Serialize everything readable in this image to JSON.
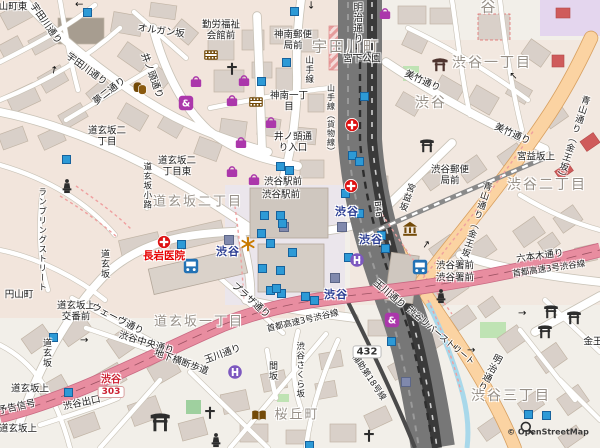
{
  "map_title": "Shibuya area map",
  "attribution": "© OpenStreetMap",
  "colors": {
    "background": "#f2efe9",
    "motorway": "#e88da0",
    "primary_road": "#fbd3a2",
    "retail_tint": "#f3dcd2",
    "rail": "#6f6f6f",
    "water": "#a8d8ea",
    "park_green": "#bfe3b4",
    "station_text": "#2b3d93",
    "shop_purple": "#ab37ab",
    "poi_brown": "#734a08",
    "hospital_red": "#dd1111",
    "entrance_blue": "#2d9ad6"
  },
  "labels": [
    {
      "t": "山町東",
      "x": 13,
      "y": 8,
      "c": "s"
    },
    {
      "t": "宇田川通り",
      "x": 45,
      "y": 24,
      "c": "s",
      "r": 55
    },
    {
      "t": "宇田川通り",
      "x": 86,
      "y": 70,
      "c": "s",
      "r": 36
    },
    {
      "t": "オルガン坂",
      "x": 161,
      "y": 32,
      "c": "s",
      "r": 8
    },
    {
      "t": "宇田川町",
      "x": 346,
      "y": 47,
      "c": "a",
      "fs": 15
    },
    {
      "t": "井ノ頭通り",
      "x": 151,
      "y": 76,
      "c": "s",
      "r": 70
    },
    {
      "t": "夢二通り",
      "x": 110,
      "y": 92,
      "c": "s",
      "r": -38
    },
    {
      "t": "勤労福祉\n会館前",
      "x": 221,
      "y": 31,
      "c": "s"
    },
    {
      "t": "神南郵便\n局前",
      "x": 293,
      "y": 41,
      "c": "s"
    },
    {
      "t": "宮下公園",
      "x": 362,
      "y": 60,
      "c": "s"
    },
    {
      "t": "神南一丁\n目",
      "x": 289,
      "y": 102,
      "c": "s"
    },
    {
      "t": "山手線",
      "x": 308,
      "y": 70,
      "c": "s",
      "v": 1,
      "fs": 8.5
    },
    {
      "t": "山手線（貨物線）",
      "x": 330,
      "y": 120,
      "c": "s",
      "v": 1,
      "fs": 8
    },
    {
      "t": "明治通り",
      "x": 356,
      "y": 23,
      "c": "s",
      "v": 1
    },
    {
      "t": "谷",
      "x": 489,
      "y": 7,
      "c": "a",
      "fs": 15
    },
    {
      "t": "渋谷一丁目",
      "x": 492,
      "y": 64,
      "c": "a",
      "fs": 14
    },
    {
      "t": "渋谷",
      "x": 431,
      "y": 104,
      "c": "a",
      "fs": 14
    },
    {
      "t": "美竹通り",
      "x": 422,
      "y": 82,
      "c": "s",
      "r": 24
    },
    {
      "t": "美竹通り",
      "x": 512,
      "y": 135,
      "c": "s",
      "r": 24
    },
    {
      "t": "宮益坂上",
      "x": 536,
      "y": 158,
      "c": "s"
    },
    {
      "t": "渋谷二丁目",
      "x": 547,
      "y": 186,
      "c": "a",
      "fs": 14
    },
    {
      "t": "青山通り（金王坂）",
      "x": 474,
      "y": 224,
      "c": "s",
      "v": 1,
      "r": 18,
      "fs": 9
    },
    {
      "t": "青山通り（金王坂）",
      "x": 572,
      "y": 138,
      "c": "s",
      "v": 1,
      "r": 18,
      "fs": 9
    },
    {
      "t": "宮益坂",
      "x": 406,
      "y": 197,
      "c": "s",
      "v": 1,
      "r": 20,
      "fs": 9
    },
    {
      "t": "渋谷郵便\n局前",
      "x": 450,
      "y": 176,
      "c": "s"
    },
    {
      "t": "道玄坂二\n丁目",
      "x": 107,
      "y": 137,
      "c": "s"
    },
    {
      "t": "道玄坂二\n丁目東",
      "x": 177,
      "y": 167,
      "c": "s"
    },
    {
      "t": "道玄坂二丁目",
      "x": 198,
      "y": 203,
      "c": "a",
      "fs": 13
    },
    {
      "t": "道玄坂小路",
      "x": 146,
      "y": 186,
      "c": "s",
      "v": 1,
      "fs": 8.5
    },
    {
      "t": "ランブリングストリート",
      "x": 41,
      "y": 240,
      "c": "s",
      "v": 1,
      "fs": 8.5
    },
    {
      "t": "道玄坂",
      "x": 104,
      "y": 264,
      "c": "s",
      "v": 1,
      "fs": 9
    },
    {
      "t": "長岩医院",
      "x": 164,
      "y": 257,
      "c": "pr"
    },
    {
      "t": "渋谷駅前",
      "x": 283,
      "y": 183,
      "c": "s"
    },
    {
      "t": "渋谷駅前",
      "x": 281,
      "y": 196,
      "c": "s"
    },
    {
      "t": "井ノ頭通\nり入口",
      "x": 293,
      "y": 143,
      "c": "s"
    },
    {
      "t": "渋谷",
      "x": 228,
      "y": 252,
      "c": "st"
    },
    {
      "t": "渋谷",
      "x": 347,
      "y": 212,
      "c": "st"
    },
    {
      "t": "渋谷",
      "x": 371,
      "y": 240,
      "c": "st"
    },
    {
      "t": "渋谷",
      "x": 336,
      "y": 295,
      "c": "st"
    },
    {
      "t": "B46",
      "x": 377,
      "y": 209,
      "c": "s",
      "r": 85,
      "fs": 8
    },
    {
      "t": "渋谷署前",
      "x": 455,
      "y": 267,
      "c": "s"
    },
    {
      "t": "渋谷署前",
      "x": 455,
      "y": 279,
      "c": "s"
    },
    {
      "t": "六本木通り",
      "x": 540,
      "y": 257,
      "c": "s",
      "r": -8
    },
    {
      "t": "首都高速3号渋谷線",
      "x": 549,
      "y": 270,
      "c": "s",
      "r": -8,
      "fs": 8.5
    },
    {
      "t": "首都高速3号渋谷線",
      "x": 303,
      "y": 322,
      "c": "s",
      "r": -13,
      "fs": 8.5
    },
    {
      "t": "玉川通り",
      "x": 223,
      "y": 355,
      "c": "s",
      "r": -20
    },
    {
      "t": "玉川通り",
      "x": 389,
      "y": 295,
      "c": "s",
      "r": 40
    },
    {
      "t": "円山町",
      "x": 19,
      "y": 296,
      "c": "s"
    },
    {
      "t": "道玄坂上\n交番前",
      "x": 76,
      "y": 312,
      "c": "s"
    },
    {
      "t": "ウェーヴ通り",
      "x": 117,
      "y": 320,
      "c": "s",
      "r": 27
    },
    {
      "t": "渋谷中央通り",
      "x": 146,
      "y": 344,
      "c": "s",
      "r": 17
    },
    {
      "t": "道玄坂一丁目",
      "x": 199,
      "y": 323,
      "c": "a",
      "fs": 13
    },
    {
      "t": "地下横断歩道",
      "x": 181,
      "y": 363,
      "c": "s",
      "r": 20
    },
    {
      "t": "道玄坂",
      "x": 46,
      "y": 353,
      "c": "s",
      "v": 1,
      "fs": 9
    },
    {
      "t": "道玄坂上",
      "x": 30,
      "y": 390,
      "c": "s"
    },
    {
      "t": "渋谷",
      "x": 111,
      "y": 380,
      "c": "hr"
    },
    {
      "t": "303",
      "x": 111,
      "y": 392,
      "c": "b3"
    },
    {
      "t": "渋谷出口",
      "x": 82,
      "y": 404,
      "c": "s",
      "r": -12
    },
    {
      "t": "予告信号",
      "x": 17,
      "y": 408,
      "c": "s",
      "r": -12
    },
    {
      "t": "道玄坂上",
      "x": 18,
      "y": 430,
      "c": "s"
    },
    {
      "t": "プラザ通り",
      "x": 250,
      "y": 301,
      "c": "s",
      "r": 42
    },
    {
      "t": "間坂",
      "x": 272,
      "y": 371,
      "c": "s",
      "v": 1,
      "fs": 9
    },
    {
      "t": "渋谷さくら坂",
      "x": 299,
      "y": 370,
      "c": "s",
      "v": 1,
      "fs": 8.5
    },
    {
      "t": "432",
      "x": 367,
      "y": 352,
      "c": "b4"
    },
    {
      "t": "補助第18号線",
      "x": 368,
      "y": 378,
      "c": "s",
      "r": 56,
      "fs": 8.5
    },
    {
      "t": "桜丘町",
      "x": 297,
      "y": 416,
      "c": "a",
      "fs": 13
    },
    {
      "t": "渋谷リバーストリート",
      "x": 440,
      "y": 337,
      "c": "s",
      "r": 40,
      "fs": 8.5
    },
    {
      "t": "明治通り",
      "x": 488,
      "y": 372,
      "c": "s",
      "v": 1,
      "r": 28
    },
    {
      "t": "渋谷三丁目",
      "x": 511,
      "y": 397,
      "c": "a",
      "fs": 14
    },
    {
      "t": "金王",
      "x": 593,
      "y": 343,
      "c": "s"
    },
    {
      "t": "© OpenStreetMap",
      "x": 548,
      "y": 433,
      "c": "wm"
    }
  ],
  "icons": [
    {
      "k": "cinema",
      "x": 211,
      "y": 55
    },
    {
      "k": "church",
      "x": 232,
      "y": 70
    },
    {
      "k": "bag",
      "x": 244,
      "y": 80
    },
    {
      "k": "bag",
      "x": 232,
      "y": 100
    },
    {
      "k": "cinema",
      "x": 256,
      "y": 102
    },
    {
      "k": "bag",
      "x": 271,
      "y": 122
    },
    {
      "k": "bag",
      "x": 241,
      "y": 142
    },
    {
      "k": "theater",
      "x": 140,
      "y": 88
    },
    {
      "k": "bag",
      "x": 196,
      "y": 81
    },
    {
      "k": "amp",
      "x": 186,
      "y": 103
    },
    {
      "k": "bag",
      "x": 385,
      "y": 13
    },
    {
      "k": "hospital",
      "x": 352,
      "y": 125
    },
    {
      "k": "shrine",
      "x": 440,
      "y": 64
    },
    {
      "k": "torii",
      "x": 427,
      "y": 145
    },
    {
      "k": "hospital",
      "x": 351,
      "y": 186
    },
    {
      "k": "museum",
      "x": 410,
      "y": 229
    },
    {
      "k": "hospital",
      "x": 164,
      "y": 242
    },
    {
      "k": "bus",
      "x": 191,
      "y": 266
    },
    {
      "k": "bag",
      "x": 232,
      "y": 171
    },
    {
      "k": "bag",
      "x": 254,
      "y": 179
    },
    {
      "k": "attraction",
      "x": 248,
      "y": 244
    },
    {
      "k": "hcircle",
      "x": 357,
      "y": 260
    },
    {
      "k": "bus",
      "x": 420,
      "y": 267
    },
    {
      "k": "statue",
      "x": 67,
      "y": 186
    },
    {
      "k": "statue",
      "x": 441,
      "y": 296
    },
    {
      "k": "hcircle",
      "x": 235,
      "y": 372
    },
    {
      "k": "amp",
      "x": 392,
      "y": 320
    },
    {
      "k": "torii",
      "x": 160,
      "y": 421,
      "sc": 1.4
    },
    {
      "k": "book",
      "x": 259,
      "y": 416
    },
    {
      "k": "church",
      "x": 210,
      "y": 414
    },
    {
      "k": "statue",
      "x": 216,
      "y": 440
    },
    {
      "k": "church",
      "x": 369,
      "y": 437
    },
    {
      "k": "torii",
      "x": 551,
      "y": 311
    },
    {
      "k": "torii",
      "x": 574,
      "y": 317
    },
    {
      "k": "torii",
      "x": 545,
      "y": 331
    },
    {
      "k": "magnifier",
      "x": 527,
      "y": 428
    }
  ],
  "entrances": [
    [
      87,
      12
    ],
    [
      294,
      11
    ],
    [
      286,
      62
    ],
    [
      261,
      81
    ],
    [
      364,
      96
    ],
    [
      66,
      159
    ],
    [
      352,
      155
    ],
    [
      359,
      161
    ],
    [
      280,
      166
    ],
    [
      289,
      170
    ],
    [
      264,
      215
    ],
    [
      280,
      215
    ],
    [
      282,
      223
    ],
    [
      261,
      233
    ],
    [
      270,
      243
    ],
    [
      292,
      252
    ],
    [
      262,
      268
    ],
    [
      280,
      270
    ],
    [
      270,
      290
    ],
    [
      281,
      293
    ],
    [
      305,
      296
    ],
    [
      314,
      300
    ],
    [
      345,
      193
    ],
    [
      359,
      213
    ],
    [
      381,
      235
    ],
    [
      385,
      248
    ],
    [
      53,
      337
    ],
    [
      68,
      392
    ],
    [
      528,
      414
    ],
    [
      546,
      415
    ],
    [
      309,
      445
    ],
    [
      276,
      288
    ],
    [
      348,
      257
    ],
    [
      391,
      341
    ],
    [
      181,
      244
    ]
  ],
  "subway_marks": [
    [
      228,
      239
    ],
    [
      283,
      226
    ],
    [
      334,
      277
    ],
    [
      405,
      381
    ],
    [
      341,
      226
    ]
  ],
  "arrows": [
    [
      80,
      3,
      180
    ],
    [
      56,
      70,
      -80
    ],
    [
      311,
      5,
      90
    ],
    [
      356,
      46,
      90
    ],
    [
      515,
      75,
      -135
    ],
    [
      428,
      245,
      -55
    ],
    [
      523,
      314,
      0
    ],
    [
      458,
      346,
      180
    ],
    [
      472,
      351,
      0
    ],
    [
      85,
      341,
      0
    ]
  ]
}
